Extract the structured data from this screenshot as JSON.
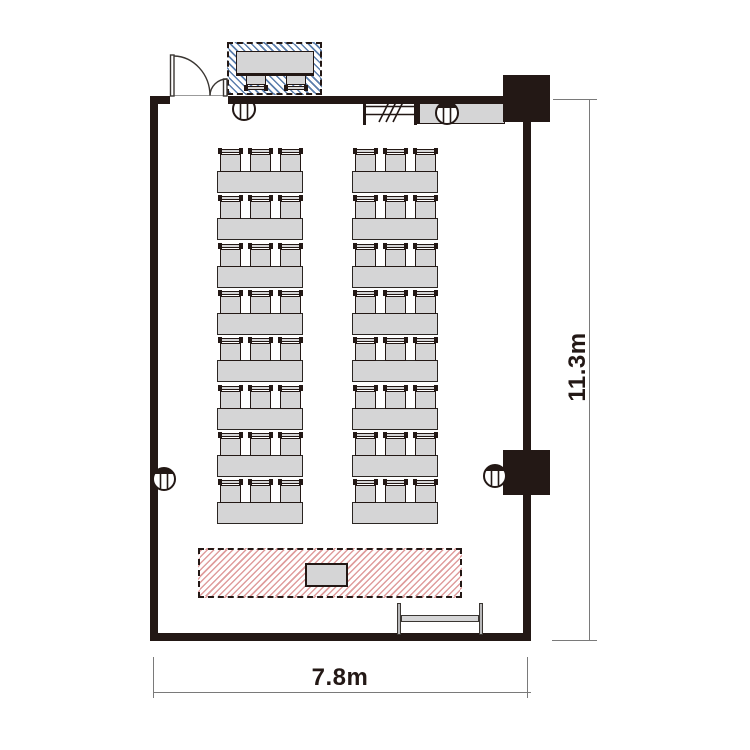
{
  "meta": {
    "type": "floor-plan",
    "room_use": "seminar room with classroom seating"
  },
  "dimensions": {
    "width_label": "7.8m",
    "height_label": "11.3m"
  },
  "floorplan": {
    "room": {
      "x": 150,
      "y": 96,
      "w": 381,
      "h": 545,
      "wall_thickness": 8
    },
    "door": {
      "gap_x": 170,
      "gap_w": 58,
      "gap_y": 95,
      "gap_h": 10
    },
    "seating": {
      "rows": 8,
      "columns": 2,
      "chairs_per_table": 3,
      "total_seats": 48,
      "column_x": [
        217,
        352
      ],
      "first_table_y": 171,
      "row_pitch": 47.3,
      "table": {
        "w": 86,
        "h": 22
      },
      "chair": {
        "w": 25,
        "h": 23,
        "gap": 5,
        "margin": 0.5
      }
    },
    "stage": {
      "x": 198,
      "y": 548,
      "w": 264,
      "h": 50,
      "lectern": {
        "x": 305,
        "y": 563,
        "w": 43,
        "h": 24
      }
    },
    "reception": {
      "x": 227,
      "y": 42,
      "w": 95,
      "h": 53,
      "table": {
        "x": 236,
        "y": 51,
        "w": 78,
        "h": 25
      },
      "chairs_x": [
        244,
        284
      ],
      "chair_y": 73,
      "chair_w": 24,
      "chair_h": 17
    },
    "counter": {
      "x": 417,
      "y": 103,
      "w": 88,
      "h": 21
    },
    "pillars": [
      {
        "x": 503,
        "y": 75,
        "w": 47,
        "h": 47
      },
      {
        "x": 503,
        "y": 450,
        "w": 47,
        "h": 45
      }
    ],
    "whiteboard": {
      "post1_x": 397,
      "post2_x": 479,
      "post_y": 603,
      "post_w": 4,
      "post_h": 32,
      "bar_x": 401,
      "bar_y": 615,
      "bar_w": 78,
      "bar_h": 7
    },
    "utility_circles": [
      {
        "cx": 244,
        "cy": 109
      },
      {
        "cx": 447,
        "cy": 113
      },
      {
        "cx": 164,
        "cy": 479
      },
      {
        "cx": 495,
        "cy": 476
      }
    ],
    "dim_right": {
      "line_x": 589,
      "y1": 99,
      "y2": 641,
      "ext_top": {
        "x1": 553,
        "x2": 597,
        "y": 99
      },
      "ext_bottom": {
        "x1": 552,
        "x2": 597,
        "y": 640
      },
      "label_cx": 577,
      "label_cy": 367
    },
    "dim_bottom": {
      "line_y": 692,
      "x1": 153,
      "x2": 531,
      "ext_left_x": 153,
      "ext_right_x": 527,
      "ext_y1": 657,
      "ext_y2": 698,
      "label_cx": 340,
      "label_cy": 678
    }
  },
  "colors": {
    "ink": "#231815",
    "furniture_fill": "#d5d5d6",
    "blue_hatch": "#3e679e",
    "red_hatch": "#c54d4d",
    "dim_line": "#7a7a7a"
  }
}
